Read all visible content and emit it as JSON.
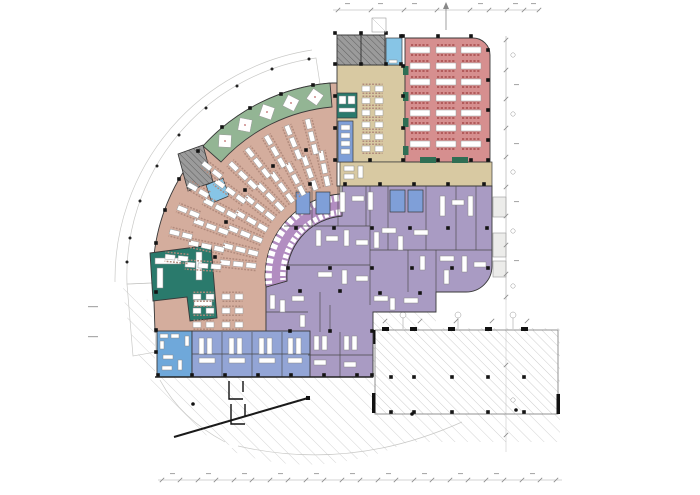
{
  "plan": {
    "kind": "architectural-floor-plan",
    "zones": {
      "dining_hall": {
        "label": "dining hall",
        "color": "#d68f8f"
      },
      "curved_dining": {
        "label": "curved dining terrace",
        "color": "#d4ad9d"
      },
      "lounge": {
        "label": "lounge / circulation",
        "color": "#d8c9a2"
      },
      "terrace": {
        "label": "garden terrace band",
        "color": "#93b594"
      },
      "servery": {
        "label": "servery counter band",
        "color": "#b28dc1"
      },
      "kitchen": {
        "label": "kitchen / back of house",
        "color": "#a99bc3"
      },
      "restroom": {
        "label": "restroom",
        "color": "#6fa8da"
      },
      "lockers": {
        "label": "washroom / locker rooms",
        "color": "#93a5d6"
      },
      "core": {
        "label": "stair core",
        "color": "#969696"
      },
      "lift": {
        "label": "lift lobby",
        "color": "#87c5e6"
      },
      "bar": {
        "label": "bar / coffee counter",
        "color": "#2a7a6c"
      },
      "walkway": {
        "label": "external walkway",
        "color": "#f1f1ee"
      }
    },
    "accents": {
      "chair": "#b25b5b",
      "chair_soft": "#b08a7c",
      "equipment_blue": "#7f9fd8",
      "planter_green": "#2f6e54",
      "wall": "#3a3a3a",
      "column": "#141414",
      "hatch_line": "#c2c2c2",
      "dimension": "#9a9a9a"
    }
  }
}
